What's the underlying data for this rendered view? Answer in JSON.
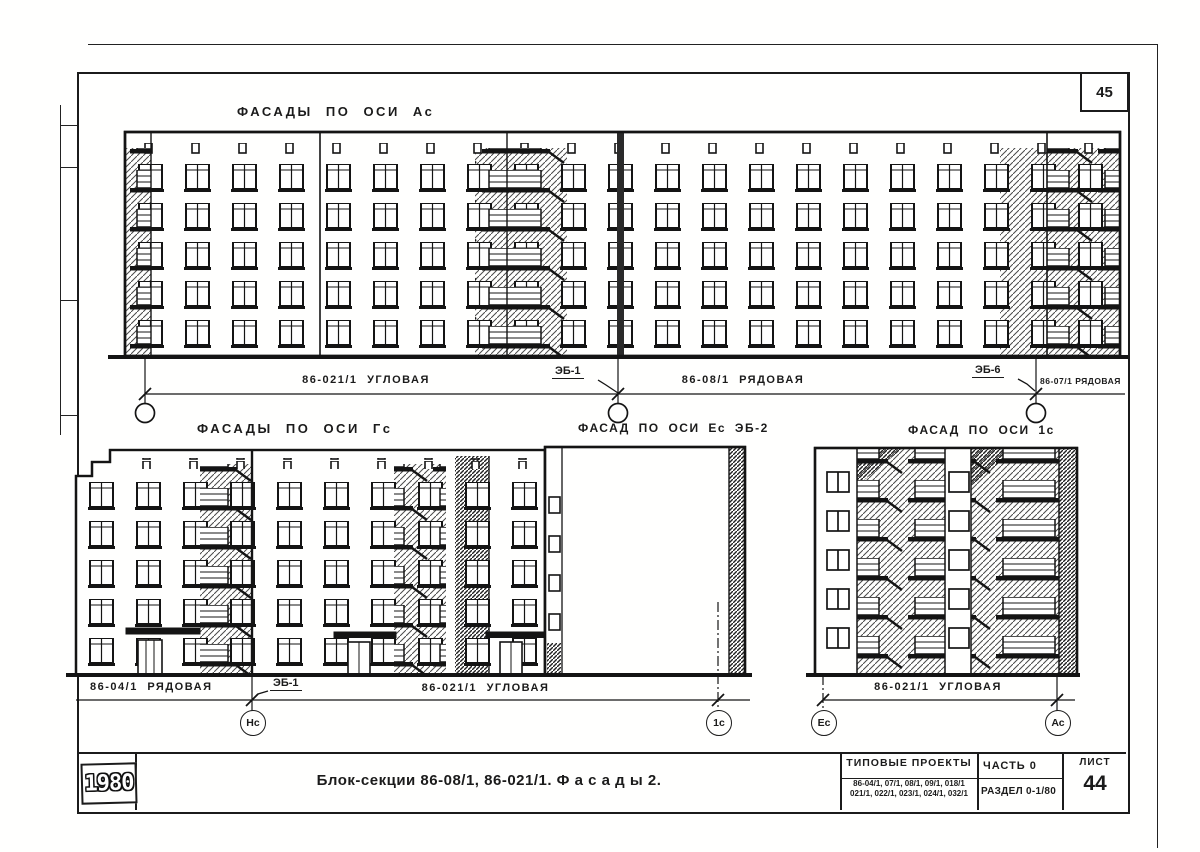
{
  "sheet": {
    "page_number": "45",
    "year_stamp": "1980"
  },
  "top_facade": {
    "title": "ФАСАДЫ ПО ОСИ Ас",
    "dim_labels": {
      "seg1": "86-021/1  УГЛОВАЯ",
      "marker1": "ЭБ-1",
      "seg2": "86-08/1  РЯДОВАЯ",
      "marker2": "ЭБ-6",
      "seg3": "86-07/1 РЯДОВАЯ"
    }
  },
  "middle_row": {
    "left_title": "ФАСАДЫ ПО ОСИ Гс",
    "center_title": "ФАСАД ПО ОСИ Ес ЭБ-2",
    "right_title": "ФАСАД ПО ОСИ 1с",
    "dim_labels": {
      "seg1": "86-04/1  РЯДОВАЯ",
      "marker1": "ЭБ-1",
      "seg2": "86-021/1  УГЛОВАЯ",
      "seg3": "86-021/1  УГЛОВАЯ"
    },
    "axis_circles": [
      "Нс",
      "1с",
      "Ес",
      "Ас"
    ]
  },
  "title_block": {
    "main_title": "Блок-секции 86-08/1, 86-021/1.   Ф а с а д ы  2.",
    "projects_header": "ТИПОВЫЕ  ПРОЕКТЫ",
    "projects_line1": "86-04/1, 07/1, 08/1, 09/1, 018/1",
    "projects_line2": "021/1, 022/1, 023/1, 024/1, 032/1",
    "part": "ЧАСТЬ 0",
    "section": "РАЗДЕЛ 0-1/80",
    "sheet_label": "ЛИСТ",
    "sheet_number": "44"
  }
}
